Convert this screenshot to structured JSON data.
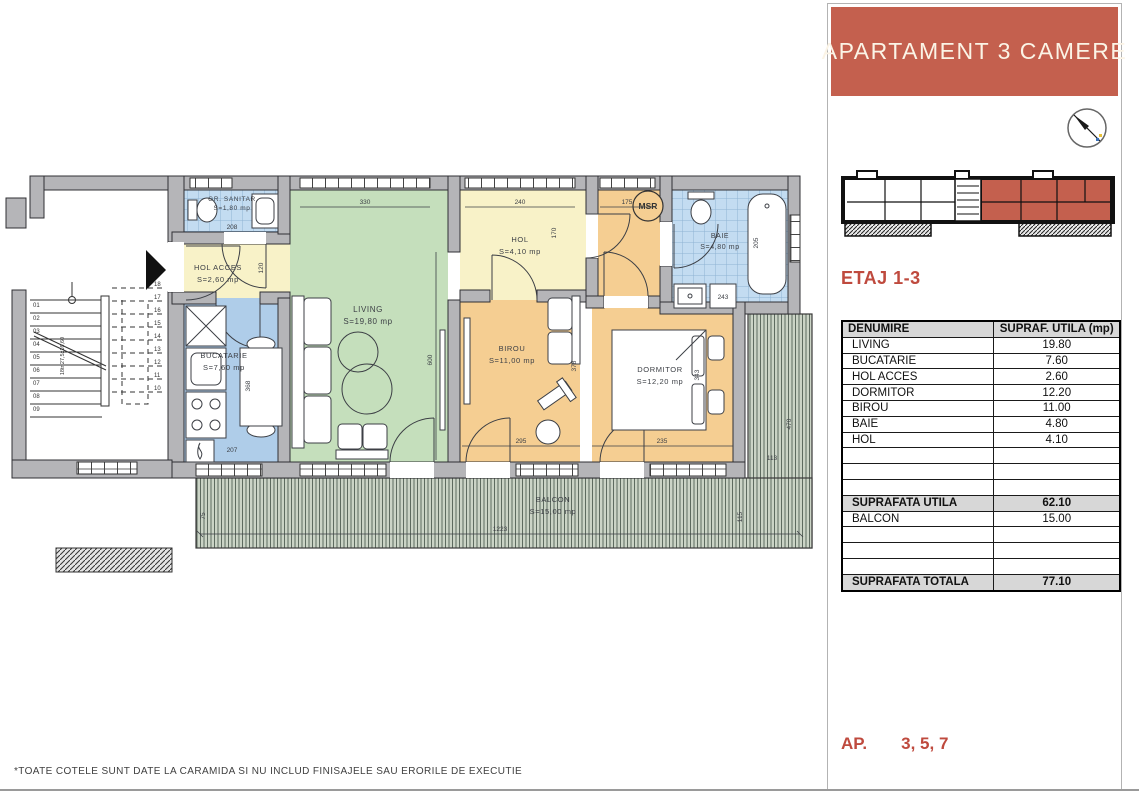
{
  "panel": {
    "title": "APARTAMENT 3 CAMERE",
    "floor_label": "ETAJ 1-3",
    "ap_prefix": "AP.",
    "ap_numbers": "3, 5, 7",
    "table": {
      "col_name": "DENUMIRE",
      "col_area": "SUPRAF. UTILA (mp)",
      "rows": [
        {
          "name": "LIVING",
          "area": "19.80"
        },
        {
          "name": "BUCATARIE",
          "area": "7.60"
        },
        {
          "name": "HOL ACCES",
          "area": "2.60"
        },
        {
          "name": "DORMITOR",
          "area": "12.20"
        },
        {
          "name": "BIROU",
          "area": "11.00"
        },
        {
          "name": "BAIE",
          "area": "4.80"
        },
        {
          "name": "HOL",
          "area": "4.10"
        }
      ],
      "subtotal_label": "SUPRAFATA UTILA",
      "subtotal_value": "62.10",
      "balcony_label": "BALCON",
      "balcony_value": "15.00",
      "total_label": "SUPRAFATA TOTALA",
      "total_value": "77.10"
    }
  },
  "plan": {
    "rooms": {
      "gr_sanitar": {
        "label": "GR. SANITAR",
        "area": "S=1,80 mp"
      },
      "hol_acces": {
        "label": "HOL ACCES",
        "area": "S=2,60 mp"
      },
      "bucatarie": {
        "label": "BUCATARIE",
        "area": "S=7,60 mp"
      },
      "living": {
        "label": "LIVING",
        "area": "S=19,80 mp"
      },
      "hol": {
        "label": "HOL",
        "area": "S=4,10 mp"
      },
      "birou": {
        "label": "BIROU",
        "area": "S=11,00 mp"
      },
      "dormitor": {
        "label": "DORMITOR",
        "area": "S=12,20 mp"
      },
      "baie": {
        "label": "BAIE",
        "area": "S=4,80 mp"
      },
      "balcon": {
        "label": "BALCON",
        "area": "S=15,00 mp"
      }
    },
    "msr": "MSR",
    "stair_note": "18tr 27,5x16,60",
    "dims": {
      "top_living": "330",
      "top_hol": "240",
      "top_right": "175",
      "gr_sanitar_width": "208",
      "hol_acces_height": "120",
      "hol_height": "170",
      "living_height": "600",
      "kitchen_height": "368",
      "kitchen_width": "207",
      "birou_width": "295",
      "birou_height": "378",
      "dormitor_width": "235",
      "dormitor_height": "343",
      "baie_counter": "243",
      "bathtub": "205",
      "balcony_left": "75",
      "balcony_length": "1223",
      "balcony_right_width": "113",
      "balcony_right_inner": "115",
      "balcony_right_height": "470"
    },
    "stairs": {
      "left": [
        "01",
        "02",
        "03",
        "04",
        "05",
        "06",
        "07",
        "08",
        "09"
      ],
      "right": [
        "18",
        "17",
        "16",
        "15",
        "14",
        "13",
        "12",
        "11",
        "10"
      ]
    }
  },
  "footnote": "*TOATE COTELE SUNT DATE LA CARAMIDA SI NU INCLUD FINISAJELE SAU ERORILE DE EXECUTIE",
  "colors": {
    "accent": "#C4604E",
    "accent_text": "#BF4A3E",
    "living": "#C5DFBC",
    "kitchen": "#AFCDE9",
    "bath_tile": "#C3DCF1",
    "hall": "#F8F2C8",
    "bedroom": "#F5CE92",
    "balcony": "#CBD4C6",
    "wall": "#B5B5B8"
  }
}
